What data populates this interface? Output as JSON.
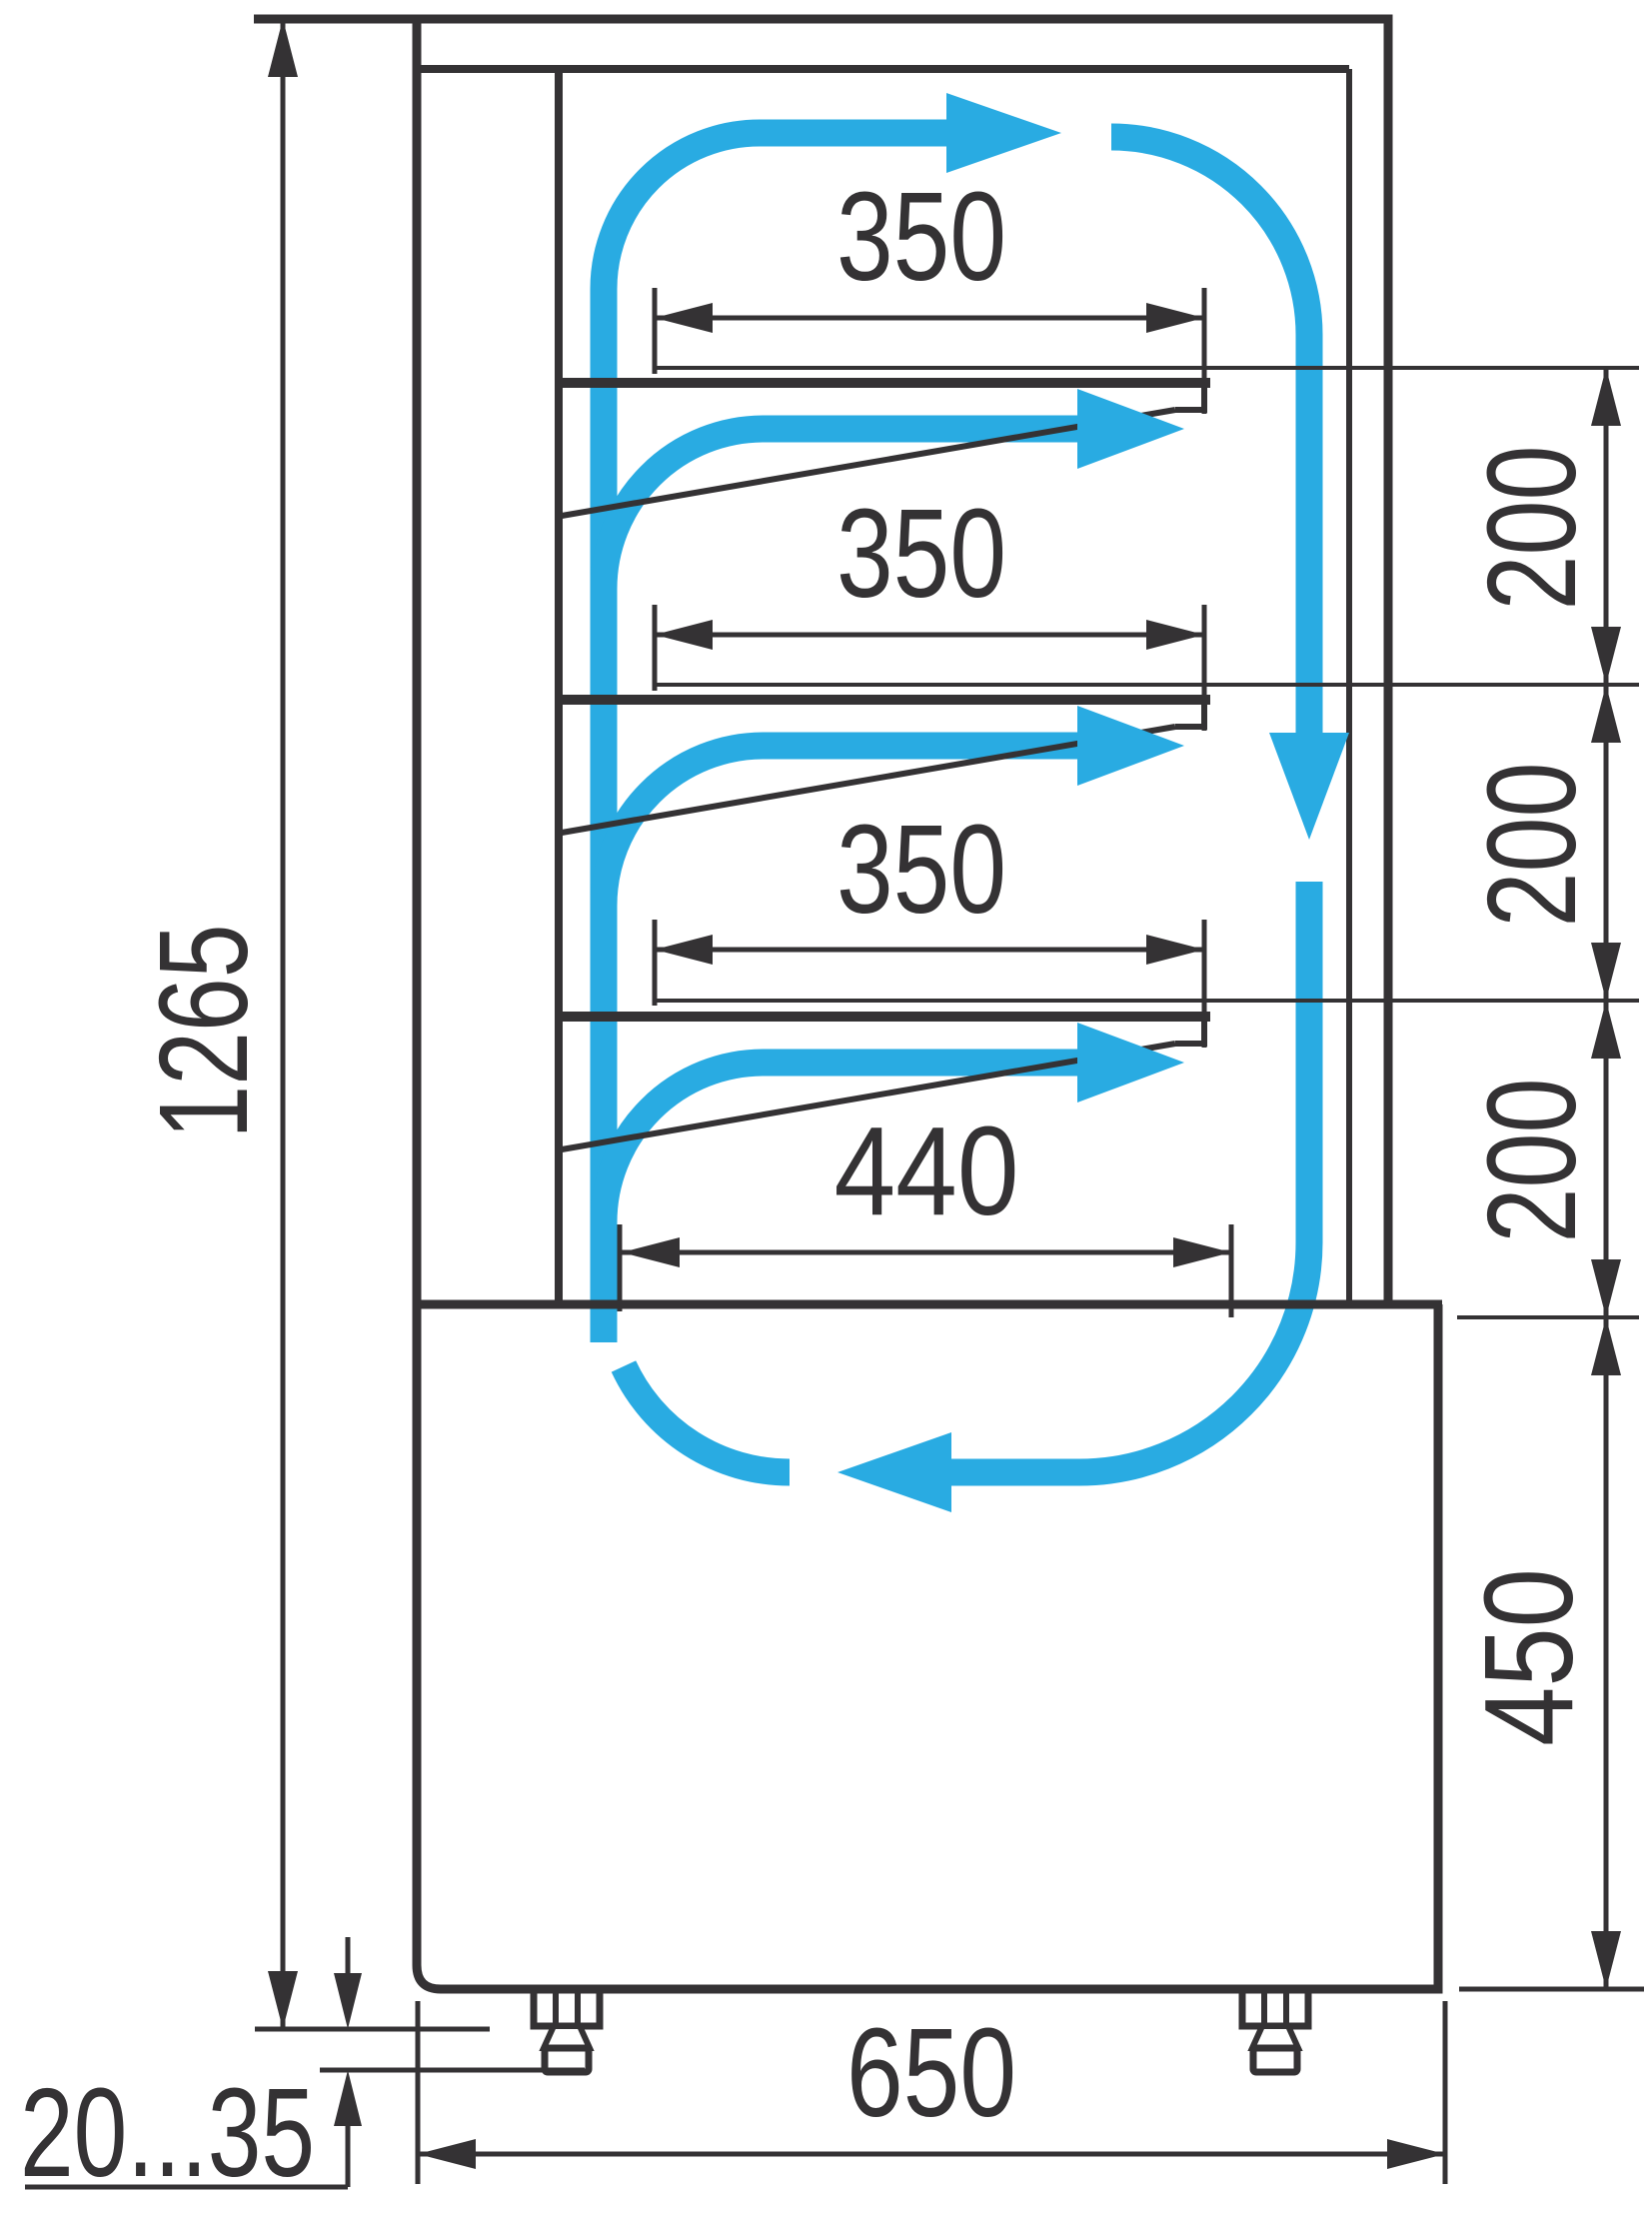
{
  "labels": {
    "total_height": "1265",
    "shelf_depths": [
      "350",
      "350",
      "350"
    ],
    "shelf_gaps": [
      "200",
      "200",
      "200"
    ],
    "bottom_shelf_depth": "440",
    "base_height": "450",
    "base_depth": "650",
    "leg_height_range": "20...35"
  },
  "colors": {
    "line": "#343234",
    "flow": "#29ABE2",
    "background": "#FFFFFF"
  }
}
